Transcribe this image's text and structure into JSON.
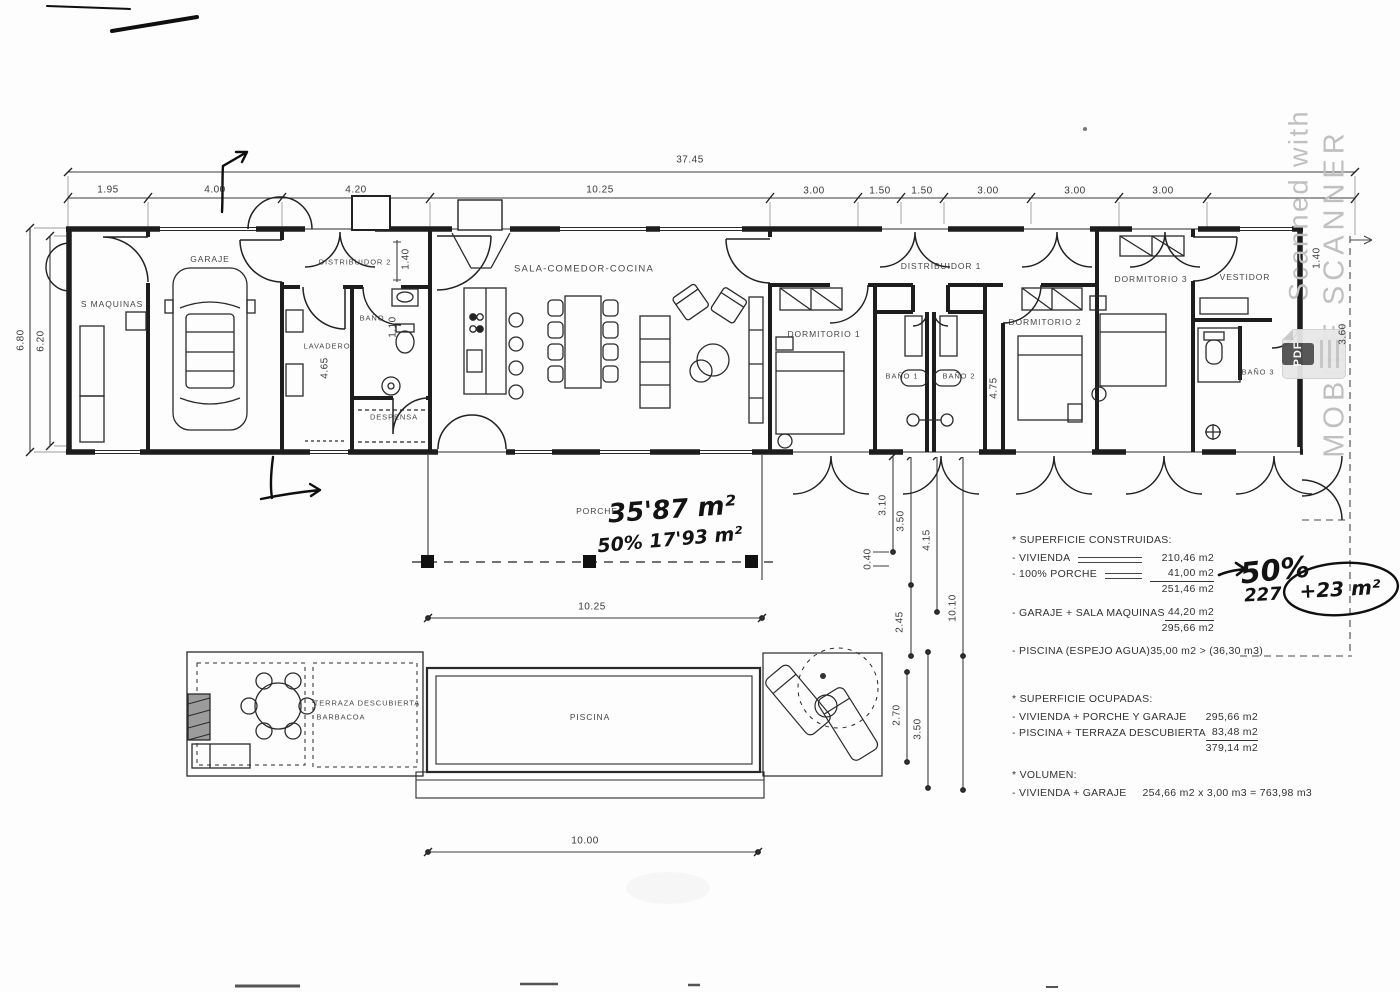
{
  "dims": {
    "overall": "37.45",
    "top": [
      "1.95",
      "4.00",
      "4.20",
      "10.25",
      "3.00",
      "1.50",
      "1.50",
      "3.00",
      "3.00",
      "3.00"
    ],
    "left_outer": "6.80",
    "left_inner": "6.20",
    "porch": "10.25",
    "pool": "10.00",
    "chain": [
      "3.10",
      "3.50",
      "4.15",
      "0.40",
      "2.45",
      "10.10",
      "2.70",
      "3.50"
    ],
    "distribuidor2": "1.40",
    "lavadero": "4.65",
    "bano": "1.10",
    "pasillo": "4.75",
    "right_inner": "1.40",
    "right_edge": "3.60"
  },
  "rooms": {
    "s_maquinas": "S MAQUINAS",
    "garaje": "GARAJE",
    "distribuidor2": "DISTRIBUIDOR 2",
    "lavadero": "LAVADERO",
    "bano": "BAÑO",
    "despensa": "DESPENSA",
    "sala": "SALA-COMEDOR-COCINA",
    "porche": "PORCHE",
    "dormitorio1": "DORMITORIO 1",
    "bano1": "BAÑO 1",
    "bano2": "BAÑO 2",
    "distribuidor1": "DISTRIBUIDOR 1",
    "dormitorio2": "DORMITORIO 2",
    "dormitorio3": "DORMITORIO 3",
    "vestidor": "VESTIDOR",
    "bano3": "BAÑO 3",
    "terraza": "TERRAZA DESCUBIERTA",
    "barbacoa": "BARBACOA",
    "piscina": "PISCINA"
  },
  "handwritten": {
    "porch_area": "35'87 m²",
    "porch_half": "50% 17'93 m²",
    "pct": "50%",
    "note": "227",
    "circled": "+23 m²"
  },
  "construidas": {
    "title": "* SUPERFICIE CONSTRUIDAS:",
    "rows": [
      {
        "label": "- VIVIENDA",
        "value": "210,46 m2"
      },
      {
        "label": "- 100% PORCHE",
        "value": "41,00 m2"
      }
    ],
    "subtotal": "251,46 m2",
    "garaje": {
      "label": "- GARAJE + SALA MAQUINAS",
      "value": "44,20 m2"
    },
    "total": "295,66 m2",
    "piscina": {
      "label": "- PISCINA (ESPEJO AGUA)",
      "value": "35,00 m2 > (36,30 m3)"
    }
  },
  "ocupadas": {
    "title": "* SUPERFICIE OCUPADAS:",
    "rows": [
      {
        "label": "- VIVIENDA + PORCHE Y GARAJE",
        "value": "295,66 m2"
      },
      {
        "label": "- PISCINA + TERRAZA DESCUBIERTA",
        "value": "83,48 m2"
      }
    ],
    "total": "379,14 m2"
  },
  "volumen": {
    "title": "* VOLUMEN:",
    "label": "- VIVIENDA + GARAJE",
    "value": "254,66 m2 x 3,00 m3 =  763,98 m3"
  },
  "watermark": {
    "line1": "Scanned with",
    "line2": "MOBILE SCANNER"
  },
  "pdf": {
    "label": "PDF"
  },
  "colors": {
    "ink": "#222222",
    "watermark": "#c0c0c0",
    "pdf_badge": "#4f4f4f"
  }
}
